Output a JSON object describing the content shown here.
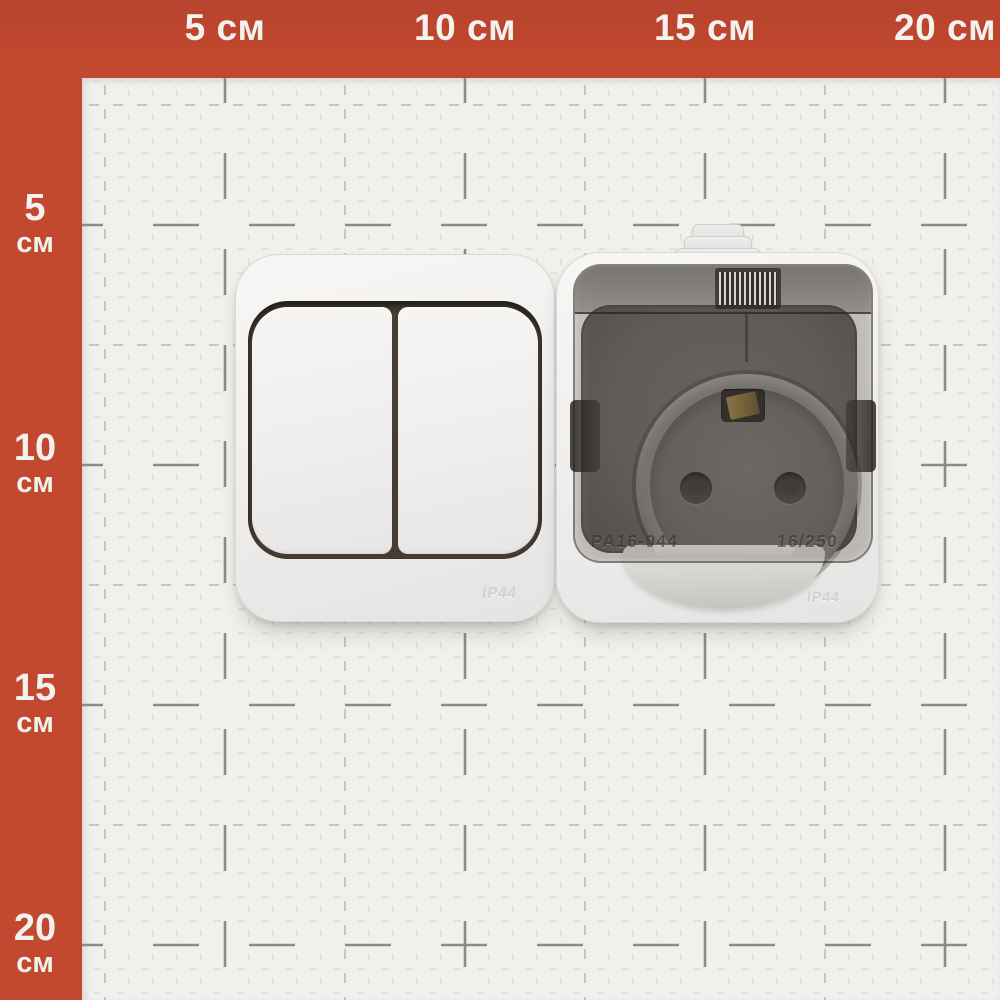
{
  "rulers": {
    "band_color": "#c2482f",
    "unit": "см",
    "top_labels": [
      "5 см",
      "10 см",
      "15 см",
      "20 см"
    ],
    "left_labels": [
      {
        "num": "5",
        "unit": "см"
      },
      {
        "num": "10",
        "unit": "см"
      },
      {
        "num": "15",
        "unit": "см"
      },
      {
        "num": "20",
        "unit": "см"
      }
    ]
  },
  "products": {
    "switch": {
      "ip_rating": "IP44"
    },
    "socket": {
      "model": "PA16-044",
      "rating": "16/250",
      "ip_rating": "IP44"
    }
  },
  "colors": {
    "ruler_band": "#c2482f",
    "grid_paper": "#f1f0ed",
    "grid_major_line": "#8d8b88",
    "socket_face": "#6b6965",
    "brass_contact": "#a98b4b"
  }
}
